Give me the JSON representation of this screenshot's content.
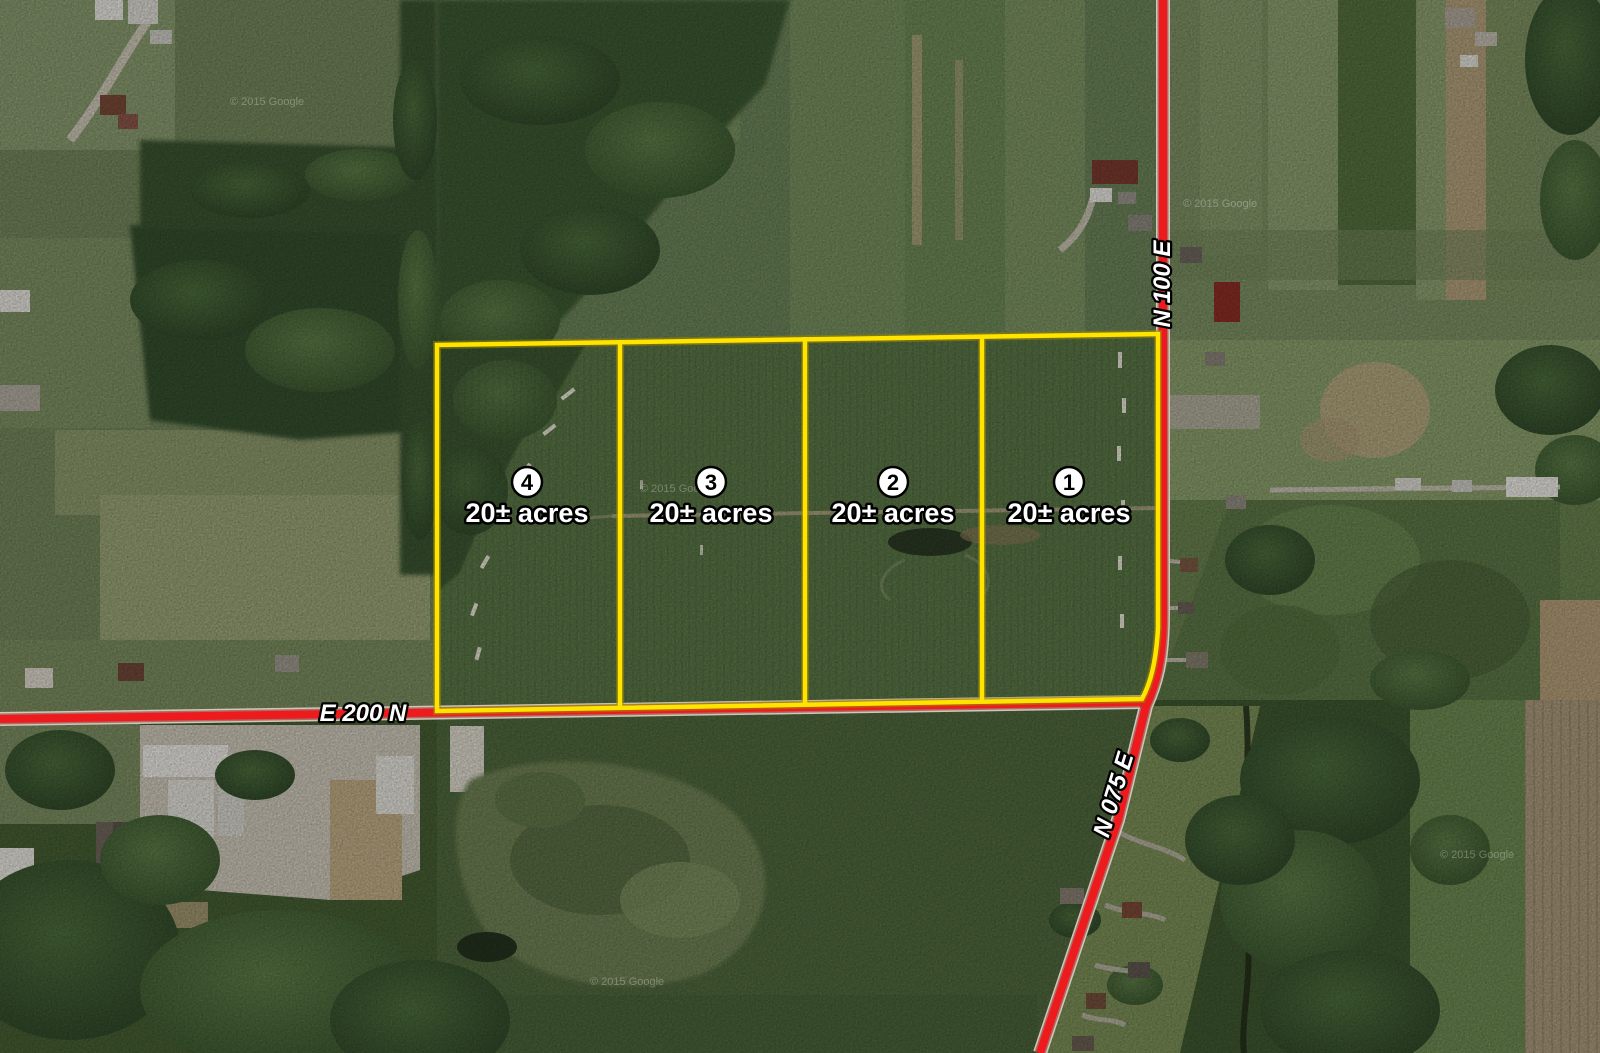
{
  "map": {
    "parcels": [
      {
        "number": "1",
        "acreage": "20± acres"
      },
      {
        "number": "2",
        "acreage": "20± acres"
      },
      {
        "number": "3",
        "acreage": "20± acres"
      },
      {
        "number": "4",
        "acreage": "20± acres"
      }
    ],
    "roads": {
      "e200n": {
        "label": "E 200 N"
      },
      "n100e": {
        "label": "N 100 E"
      },
      "n075e": {
        "label": "N 075 E"
      }
    },
    "watermark": "© 2015 Google",
    "colors": {
      "parcel_outline": "#ffe400",
      "road": "#ed1b1d",
      "label": "#ffffff"
    }
  }
}
